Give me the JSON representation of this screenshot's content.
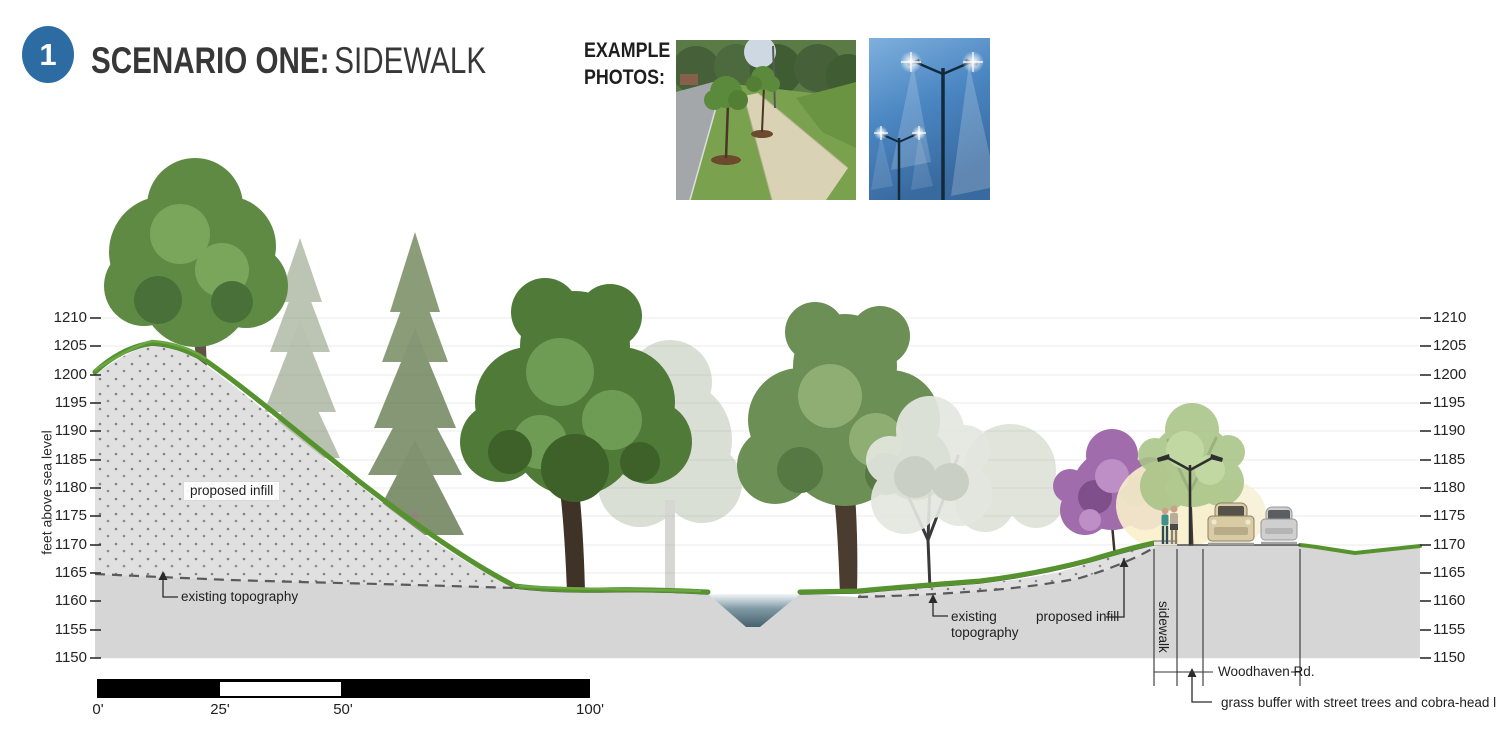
{
  "badge": {
    "number": "1"
  },
  "header": {
    "title_bold": "SCENARIO ONE:",
    "title_regular": "SIDEWALK"
  },
  "photos": {
    "label": "EXAMPLE PHOTOS:",
    "items": [
      {
        "name": "sidewalk with grass buffer and street trees"
      },
      {
        "name": "double-arm cobra-head street lights"
      }
    ]
  },
  "axis": {
    "title": "feet above sea level",
    "ticks": [
      "1210",
      "1205",
      "1200",
      "1195",
      "1190",
      "1185",
      "1180",
      "1175",
      "1170",
      "1165",
      "1160",
      "1155",
      "1150"
    ]
  },
  "annotations": {
    "proposed_infill_left": "proposed infill",
    "existing_topography_left": "existing topography",
    "existing_topography_right_line1": "existing",
    "existing_topography_right_line2": "topography",
    "proposed_infill_right": "proposed infill",
    "sidewalk": "sidewalk",
    "road_name": "Woodhaven Rd.",
    "grass_buffer": "grass buffer with street trees and cobra-head lighting"
  },
  "scale_bar": {
    "labels": [
      "0'",
      "25'",
      "50'",
      "100'"
    ]
  },
  "colors": {
    "badge_blue": "#2d6ca3",
    "ground_gray": "#d6d6d6",
    "infill_gray": "#e0e0e0",
    "grass_green": "#56932f",
    "stream_blue": "#4e6b7a",
    "dashed_line": "#5a5a5a"
  }
}
